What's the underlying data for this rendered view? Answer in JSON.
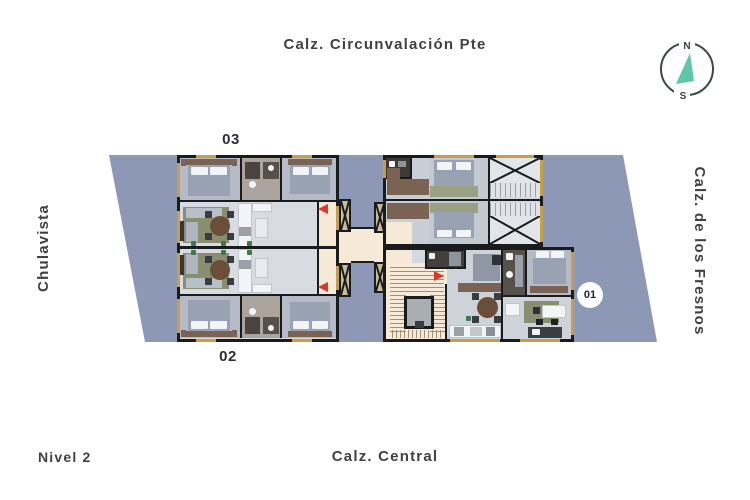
{
  "labels": {
    "street_top": "Calz. Circunvalación Pte",
    "street_left": "Chulavista",
    "street_right": "Calz. de los Fresnos",
    "street_bottom": "Calz. Central",
    "level": "Nivel 2"
  },
  "compass": {
    "north": "N",
    "south": "S"
  },
  "units": [
    {
      "id": "unit-03",
      "label": "03"
    },
    {
      "id": "unit-02",
      "label": "02"
    },
    {
      "id": "unit-01",
      "label": "01"
    }
  ],
  "colors": {
    "plot": "#8d98b6",
    "building_floor": "#d4d9e0",
    "bedroom_floor": "#b4bbc7",
    "wall": "#1a1b1d",
    "cream": "#f6e9d8",
    "column": "#c9bc9b",
    "sill": "#c79f4a",
    "red_marker": "#d93a2b",
    "needle": "#5ec7a4",
    "text": "#404144",
    "bed": "#98a2b2",
    "wood": "#7b6353",
    "rug": "#8a8e71",
    "white_fixture": "#f3f4f6"
  }
}
